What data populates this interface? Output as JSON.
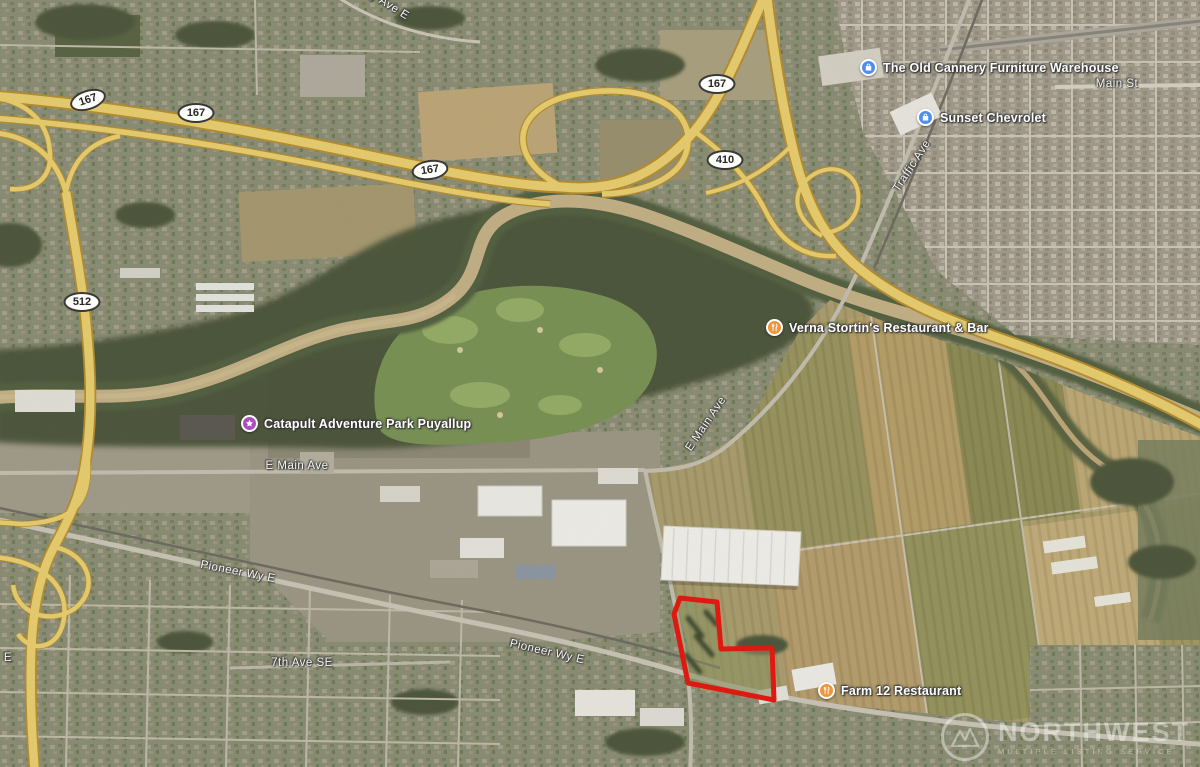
{
  "pois": [
    {
      "name": "The Old Cannery Furniture Warehouse",
      "type": "shopping"
    },
    {
      "name": "Sunset Chevrolet",
      "type": "car-dealer"
    },
    {
      "name": "Verna Stortin's Restaurant & Bar",
      "type": "restaurant"
    },
    {
      "name": "Catapult Adventure Park Puyallup",
      "type": "attraction"
    },
    {
      "name": "Farm 12 Restaurant",
      "type": "restaurant"
    }
  ],
  "streets": [
    {
      "text": "E Main Ave"
    },
    {
      "text": "E Main Ave"
    },
    {
      "text": "Pioneer Wy E"
    },
    {
      "text": "Pioneer Wy E"
    },
    {
      "text": "7th Ave SE"
    },
    {
      "text": "Traffic Ave"
    },
    {
      "text": "Main St"
    },
    {
      "text": "y Ave E"
    },
    {
      "text": "E"
    }
  ],
  "shields": [
    {
      "num": "167"
    },
    {
      "num": "167"
    },
    {
      "num": "167"
    },
    {
      "num": "167"
    },
    {
      "num": "410"
    },
    {
      "num": "512"
    }
  ],
  "watermark": {
    "line1": "NORTHWEST",
    "line2": "MULTIPLE LISTING SERVICE"
  },
  "colors": {
    "parcel_outline": "#e8150d",
    "highway_yellow": "#ecd06f",
    "pin_blue": "#4e8df5",
    "pin_orange": "#f0953c",
    "pin_purple": "#a94fc0"
  }
}
